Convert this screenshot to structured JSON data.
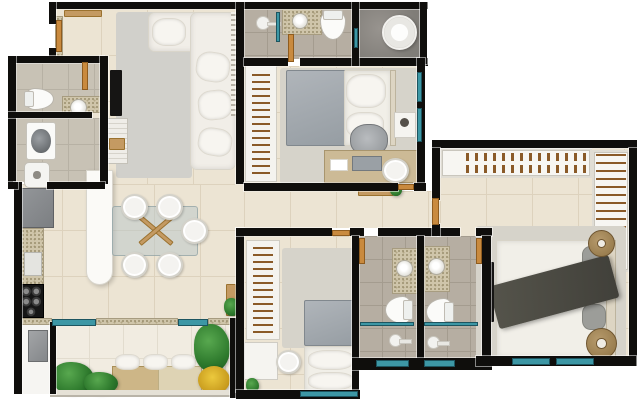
{
  "app": {
    "type": "3d-apartment-floor-plan-render",
    "background": "#ffffff",
    "canvas": {
      "width": 642,
      "height": 400
    }
  },
  "palette": {
    "wall": "#0f0e0c",
    "floor_beige": "#ece4d3",
    "floor_bath": "#b6aea2",
    "floor_dark_marble": "#8f8b86",
    "floor_balcony": "#f1ece1",
    "rug_gray": "#d1d0cb",
    "window_glass_teal": "#3d97a5",
    "door_wood": "#c98a3e",
    "granite_counter": "#cfc5aa",
    "sofa_white": "#f1eee8",
    "blanket_gray": "#a6acb1",
    "throw_dark": "#4d4c44",
    "plant_green": "#2e7a2d",
    "plant_yellow": "#dfb32a",
    "appliance_gray": "#8b8e91",
    "stove_black": "#161616",
    "closet_white": "#f7f6f2",
    "hanger_brown": "#8a5a28",
    "side_table_tan": "#a8906a"
  },
  "rooms": [
    {
      "n": "living-room-floor",
      "f": "beige",
      "x": 55,
      "y": 9,
      "w": 189,
      "h": 175
    },
    {
      "n": "kitchen-dining-floor",
      "f": "beige",
      "x": 16,
      "y": 184,
      "w": 228,
      "h": 136
    },
    {
      "n": "wc-floor",
      "f": "laundry",
      "x": 16,
      "y": 63,
      "w": 84,
      "h": 50
    },
    {
      "n": "laundry-floor",
      "f": "laundry",
      "x": 16,
      "y": 118,
      "w": 84,
      "h": 64
    },
    {
      "n": "top-bathroom-floor",
      "f": "bath",
      "x": 244,
      "y": 9,
      "w": 108,
      "h": 50
    },
    {
      "n": "shower-room-floor",
      "f": "dark",
      "x": 359,
      "y": 9,
      "w": 61,
      "h": 50
    },
    {
      "n": "bedroom2-floor",
      "f": "beige",
      "x": 244,
      "y": 66,
      "w": 173,
      "h": 117
    },
    {
      "n": "hallway-floor",
      "f": "beige",
      "x": 244,
      "y": 191,
      "w": 188,
      "h": 37
    },
    {
      "n": "master-entry-floor",
      "f": "beige",
      "x": 432,
      "y": 196,
      "w": 8,
      "h": 32
    },
    {
      "n": "master-suite-upper-floor",
      "f": "beige",
      "x": 440,
      "y": 148,
      "w": 189,
      "h": 88
    },
    {
      "n": "master-suite-lower-floor",
      "f": "beige",
      "x": 478,
      "y": 236,
      "w": 151,
      "h": 122
    },
    {
      "n": "bedroom3-floor",
      "f": "beige",
      "x": 244,
      "y": 236,
      "w": 108,
      "h": 156
    },
    {
      "n": "bathroom-a-floor",
      "f": "bath",
      "x": 359,
      "y": 236,
      "w": 58,
      "h": 124
    },
    {
      "n": "bathroom-b-floor",
      "f": "bath",
      "x": 424,
      "y": 236,
      "w": 58,
      "h": 124
    },
    {
      "n": "balcony-floor",
      "f": "balc",
      "x": 55,
      "y": 324,
      "w": 175,
      "h": 70
    },
    {
      "n": "service-closet-floor",
      "f": "white",
      "x": 22,
      "y": 322,
      "w": 28,
      "h": 72
    }
  ],
  "furniture": [
    {
      "n": "living-rug",
      "t": "rug",
      "x": 116,
      "y": 12,
      "w": 76,
      "h": 166
    },
    {
      "n": "sofa-top-section",
      "t": "sofa",
      "x": 148,
      "y": 12,
      "w": 88,
      "h": 40
    },
    {
      "n": "sofa-right-section",
      "t": "sofa",
      "x": 190,
      "y": 12,
      "w": 46,
      "h": 158
    },
    {
      "n": "sofa-chaise-cushion",
      "t": "pillow",
      "x": 152,
      "y": 18,
      "w": 34,
      "h": 28
    },
    {
      "n": "sofa-cushion",
      "t": "pillow",
      "x": 196,
      "y": 52,
      "w": 34,
      "h": 30,
      "r": 8
    },
    {
      "n": "sofa-cushion",
      "t": "pillow",
      "x": 198,
      "y": 90,
      "w": 34,
      "h": 30,
      "r": -6
    },
    {
      "n": "sofa-cushion",
      "t": "pillow",
      "x": 198,
      "y": 128,
      "w": 34,
      "h": 28,
      "r": 10
    },
    {
      "n": "slat-panel",
      "t": "slat",
      "x": 231,
      "y": 12,
      "w": 6,
      "h": 104
    },
    {
      "n": "living-tv",
      "t": "tv",
      "x": 110,
      "y": 70,
      "w": 12,
      "h": 46
    },
    {
      "n": "tv-cabinet",
      "t": "cabinet",
      "x": 106,
      "y": 118,
      "w": 22,
      "h": 46
    },
    {
      "n": "tv-cabinet-box",
      "t": "wood",
      "x": 109,
      "y": 138,
      "w": 16,
      "h": 12
    },
    {
      "n": "entry-shelf",
      "t": "wood",
      "x": 64,
      "y": 10,
      "w": 38,
      "h": 7
    },
    {
      "n": "entry-mat",
      "t": "granite",
      "x": 55,
      "y": 16,
      "w": 8,
      "h": 44
    },
    {
      "n": "wc-toilet",
      "t": "toilet",
      "x": 28,
      "y": 84,
      "w": 22,
      "h": 30,
      "r": -90
    },
    {
      "n": "wc-vanity",
      "t": "granite",
      "x": 62,
      "y": 96,
      "w": 40,
      "h": 17
    },
    {
      "n": "wc-sink",
      "t": "sink",
      "x": 70,
      "y": 99,
      "w": 17,
      "h": 17
    },
    {
      "n": "washing-machine",
      "t": "washer",
      "x": 26,
      "y": 122,
      "w": 30,
      "h": 38
    },
    {
      "n": "laundry-tank-sink",
      "t": "tanksink",
      "x": 24,
      "y": 162,
      "w": 26,
      "h": 26
    },
    {
      "n": "fridge",
      "t": "fridge",
      "x": 16,
      "y": 188,
      "w": 38,
      "h": 40
    },
    {
      "n": "kitchen-counter",
      "t": "granite",
      "x": 16,
      "y": 228,
      "w": 28,
      "h": 92
    },
    {
      "n": "kitchen-appliance",
      "t": "appliance-w",
      "x": 24,
      "y": 252,
      "w": 18,
      "h": 24
    },
    {
      "n": "stove-cooktop",
      "t": "stove",
      "x": 18,
      "y": 284,
      "w": 26,
      "h": 34
    },
    {
      "n": "kitchen-island",
      "t": "island",
      "x": 86,
      "y": 170,
      "w": 27,
      "h": 115
    },
    {
      "n": "dining-table-glass",
      "t": "glass",
      "x": 112,
      "y": 206,
      "w": 86,
      "h": 50
    },
    {
      "n": "table-base-beam",
      "t": "wood",
      "x": 135,
      "y": 228,
      "w": 42,
      "h": 5,
      "r": 40
    },
    {
      "n": "table-base-beam",
      "t": "wood",
      "x": 135,
      "y": 228,
      "w": 42,
      "h": 5,
      "r": -40
    },
    {
      "n": "dining-chair",
      "t": "chair",
      "x": 121,
      "y": 194,
      "w": 27,
      "h": 26
    },
    {
      "n": "dining-chair",
      "t": "chair",
      "x": 156,
      "y": 194,
      "w": 27,
      "h": 26
    },
    {
      "n": "dining-chair",
      "t": "chair",
      "x": 181,
      "y": 218,
      "w": 27,
      "h": 26
    },
    {
      "n": "dining-chair",
      "t": "chair",
      "x": 121,
      "y": 252,
      "w": 27,
      "h": 26
    },
    {
      "n": "dining-chair",
      "t": "chair",
      "x": 156,
      "y": 252,
      "w": 27,
      "h": 26
    },
    {
      "n": "wall-shelf",
      "t": "wood",
      "x": 226,
      "y": 284,
      "w": 10,
      "h": 32
    },
    {
      "n": "shelf-plant",
      "t": "plant",
      "x": 224,
      "y": 298,
      "w": 16,
      "h": 18
    },
    {
      "n": "window-sill",
      "t": "granite",
      "x": 14,
      "y": 318,
      "w": 38,
      "h": 7
    },
    {
      "n": "window-sill",
      "t": "granite",
      "x": 96,
      "y": 318,
      "w": 82,
      "h": 7
    },
    {
      "n": "window-sill",
      "t": "granite",
      "x": 208,
      "y": 318,
      "w": 28,
      "h": 7
    },
    {
      "n": "balcony-bench",
      "t": "bench",
      "x": 112,
      "y": 366,
      "w": 90,
      "h": 26
    },
    {
      "n": "balcony-bench-wicker",
      "t": "bench2",
      "x": 158,
      "y": 366,
      "w": 44,
      "h": 26
    },
    {
      "n": "bench-cushion",
      "t": "pillow",
      "x": 115,
      "y": 354,
      "w": 25,
      "h": 16
    },
    {
      "n": "bench-cushion",
      "t": "pillow",
      "x": 143,
      "y": 354,
      "w": 25,
      "h": 16
    },
    {
      "n": "bench-cushion",
      "t": "pillow",
      "x": 171,
      "y": 354,
      "w": 25,
      "h": 16
    },
    {
      "n": "balcony-plant",
      "t": "plant",
      "x": 52,
      "y": 362,
      "w": 42,
      "h": 32
    },
    {
      "n": "balcony-plant",
      "t": "plant",
      "x": 84,
      "y": 372,
      "w": 34,
      "h": 22
    },
    {
      "n": "balcony-tall-plant",
      "t": "plant",
      "x": 194,
      "y": 324,
      "w": 36,
      "h": 48
    },
    {
      "n": "balcony-yellow-plant",
      "t": "plant-y",
      "x": 198,
      "y": 366,
      "w": 32,
      "h": 28
    },
    {
      "n": "service-heater",
      "t": "appliance",
      "x": 28,
      "y": 330,
      "w": 20,
      "h": 32
    },
    {
      "n": "balcony-parapet",
      "t": "wall-light",
      "x": 50,
      "y": 390,
      "w": 188,
      "h": 7
    },
    {
      "n": "shower-head",
      "t": "shower",
      "x": 256,
      "y": 16,
      "w": 14,
      "h": 14
    },
    {
      "n": "bath-vanity",
      "t": "granite",
      "x": 282,
      "y": 9,
      "w": 40,
      "h": 26
    },
    {
      "n": "bath-sink",
      "t": "sink",
      "x": 292,
      "y": 13,
      "w": 16,
      "h": 16
    },
    {
      "n": "bath-toilet",
      "t": "toilet",
      "x": 320,
      "y": 10,
      "w": 26,
      "h": 30
    },
    {
      "n": "round-shower-tray",
      "t": "roundfix",
      "x": 382,
      "y": 15,
      "w": 35,
      "h": 35
    },
    {
      "n": "bedroom2-wardrobe",
      "t": "wardrobe",
      "x": 245,
      "y": 64,
      "w": 32,
      "h": 118
    },
    {
      "n": "bedroom2-rug",
      "t": "rug2",
      "x": 280,
      "y": 68,
      "w": 138,
      "h": 116
    },
    {
      "n": "bedroom2-bed-blanket",
      "t": "bedG",
      "x": 286,
      "y": 70,
      "w": 60,
      "h": 76
    },
    {
      "n": "bedroom2-bed-sheet",
      "t": "bedW",
      "x": 344,
      "y": 70,
      "w": 48,
      "h": 76
    },
    {
      "n": "bedroom2-pillow",
      "t": "pillow",
      "x": 346,
      "y": 74,
      "w": 40,
      "h": 34
    },
    {
      "n": "bedroom2-pillow",
      "t": "pillow",
      "x": 346,
      "y": 112,
      "w": 38,
      "h": 26
    },
    {
      "n": "bedroom2-headboard",
      "t": "headboard",
      "x": 390,
      "y": 70,
      "w": 6,
      "h": 76
    },
    {
      "n": "bedroom2-nightstand",
      "t": "cabinetW",
      "x": 394,
      "y": 112,
      "w": 22,
      "h": 26
    },
    {
      "n": "nightstand-lamp",
      "t": "dot",
      "x": 400,
      "y": 118,
      "w": 9,
      "h": 9
    },
    {
      "n": "office-chair",
      "t": "ochair",
      "x": 350,
      "y": 124,
      "w": 38,
      "h": 32
    },
    {
      "n": "bedroom2-desk",
      "t": "desk",
      "x": 324,
      "y": 150,
      "w": 96,
      "h": 33
    },
    {
      "n": "desk-laptop",
      "t": "laptop",
      "x": 352,
      "y": 156,
      "w": 30,
      "h": 15
    },
    {
      "n": "desk-paper",
      "t": "paper",
      "x": 330,
      "y": 159,
      "w": 18,
      "h": 12
    },
    {
      "n": "desk-chair",
      "t": "chair",
      "x": 382,
      "y": 158,
      "w": 27,
      "h": 25
    },
    {
      "n": "hall-console",
      "t": "wood",
      "x": 358,
      "y": 188,
      "w": 36,
      "h": 8
    },
    {
      "n": "hall-plant",
      "t": "plant",
      "x": 390,
      "y": 184,
      "w": 12,
      "h": 12
    },
    {
      "n": "master-closet-top",
      "t": "closet",
      "x": 440,
      "y": 148,
      "w": 152,
      "h": 30
    },
    {
      "n": "closet-shoe-row",
      "t": "shoes",
      "x": 466,
      "y": 153,
      "w": 122,
      "h": 8
    },
    {
      "n": "closet-shoe-row",
      "t": "shoes",
      "x": 466,
      "y": 165,
      "w": 122,
      "h": 8
    },
    {
      "n": "master-closet-right",
      "t": "closet",
      "x": 592,
      "y": 150,
      "w": 38,
      "h": 122
    },
    {
      "n": "closet-hanger-rail",
      "t": "hangv",
      "x": 596,
      "y": 154,
      "w": 30,
      "h": 114
    },
    {
      "n": "master-rug",
      "t": "rug2",
      "x": 476,
      "y": 226,
      "w": 150,
      "h": 136
    },
    {
      "n": "master-bed-duvet",
      "t": "bedW",
      "x": 496,
      "y": 240,
      "w": 102,
      "h": 118
    },
    {
      "n": "master-bed-pillow",
      "t": "pilG",
      "x": 582,
      "y": 246,
      "w": 24,
      "h": 24
    },
    {
      "n": "master-bed-pillow",
      "t": "pilG",
      "x": 582,
      "y": 274,
      "w": 24,
      "h": 26
    },
    {
      "n": "master-bed-pillow",
      "t": "pilG",
      "x": 582,
      "y": 304,
      "w": 24,
      "h": 26
    },
    {
      "n": "master-headboard",
      "t": "headboard",
      "x": 606,
      "y": 240,
      "w": 10,
      "h": 118
    },
    {
      "n": "master-throw-blanket",
      "t": "throw",
      "x": 492,
      "y": 270,
      "w": 124,
      "h": 44,
      "r": -15
    },
    {
      "n": "master-side-table",
      "t": "sidetable",
      "x": 588,
      "y": 230,
      "w": 27,
      "h": 27
    },
    {
      "n": "master-side-table",
      "t": "sidetable",
      "x": 586,
      "y": 328,
      "w": 31,
      "h": 31
    },
    {
      "n": "master-wall-tv",
      "t": "tv",
      "x": 488,
      "y": 262,
      "w": 6,
      "h": 60
    },
    {
      "n": "bedroom3-wardrobe",
      "t": "wardrobe",
      "x": 246,
      "y": 240,
      "w": 34,
      "h": 100
    },
    {
      "n": "bedroom3-rug",
      "t": "rug2",
      "x": 282,
      "y": 248,
      "w": 76,
      "h": 100
    },
    {
      "n": "bedroom3-bed-blanket",
      "t": "bedG",
      "x": 304,
      "y": 300,
      "w": 54,
      "h": 46
    },
    {
      "n": "bedroom3-bed-sheet",
      "t": "bedW",
      "x": 304,
      "y": 346,
      "w": 54,
      "h": 46
    },
    {
      "n": "bedroom3-pillow",
      "t": "pillow",
      "x": 308,
      "y": 350,
      "w": 46,
      "h": 20
    },
    {
      "n": "bedroom3-pillow",
      "t": "pillow",
      "x": 308,
      "y": 372,
      "w": 46,
      "h": 18
    },
    {
      "n": "bedroom3-desk",
      "t": "cabinetW",
      "x": 244,
      "y": 342,
      "w": 34,
      "h": 38
    },
    {
      "n": "bedroom3-chair",
      "t": "chair",
      "x": 276,
      "y": 350,
      "w": 25,
      "h": 24
    },
    {
      "n": "bedroom3-plant",
      "t": "plant",
      "x": 246,
      "y": 378,
      "w": 13,
      "h": 15
    },
    {
      "n": "bathroom-a-vanity",
      "t": "granite",
      "x": 392,
      "y": 248,
      "w": 26,
      "h": 46
    },
    {
      "n": "bathroom-a-sink",
      "t": "sink",
      "x": 396,
      "y": 260,
      "w": 17,
      "h": 17
    },
    {
      "n": "bathroom-a-toilet",
      "t": "toilet",
      "x": 385,
      "y": 296,
      "w": 28,
      "h": 28,
      "r": 90
    },
    {
      "n": "bathroom-a-shower-head",
      "t": "shower",
      "x": 389,
      "y": 334,
      "w": 13,
      "h": 13
    },
    {
      "n": "bathroom-b-vanity",
      "t": "granite",
      "x": 424,
      "y": 246,
      "w": 26,
      "h": 46
    },
    {
      "n": "bathroom-b-sink",
      "t": "sink",
      "x": 428,
      "y": 258,
      "w": 17,
      "h": 17
    },
    {
      "n": "bathroom-b-toilet",
      "t": "toilet",
      "x": 426,
      "y": 298,
      "w": 28,
      "h": 28,
      "r": 90
    },
    {
      "n": "bathroom-b-shower-head",
      "t": "shower",
      "x": 427,
      "y": 336,
      "w": 13,
      "h": 13
    }
  ],
  "walls": [
    [
      55,
      2,
      373,
      7
    ],
    [
      49,
      2,
      7,
      22
    ],
    [
      49,
      48,
      7,
      14
    ],
    [
      8,
      56,
      96,
      7
    ],
    [
      8,
      56,
      8,
      130
    ],
    [
      14,
      182,
      8,
      212
    ],
    [
      100,
      56,
      8,
      128
    ],
    [
      8,
      112,
      84,
      6
    ],
    [
      8,
      182,
      10,
      7
    ],
    [
      47,
      182,
      58,
      7
    ],
    [
      50,
      322,
      6,
      72
    ],
    [
      230,
      318,
      8,
      80
    ],
    [
      236,
      2,
      8,
      182
    ],
    [
      244,
      58,
      44,
      8
    ],
    [
      300,
      58,
      128,
      8
    ],
    [
      352,
      2,
      7,
      64
    ],
    [
      420,
      2,
      7,
      62
    ],
    [
      417,
      58,
      8,
      132
    ],
    [
      244,
      183,
      154,
      8
    ],
    [
      414,
      183,
      12,
      8
    ],
    [
      236,
      228,
      8,
      164
    ],
    [
      236,
      228,
      96,
      8
    ],
    [
      350,
      228,
      14,
      8
    ],
    [
      378,
      228,
      60,
      8
    ],
    [
      438,
      228,
      22,
      8
    ],
    [
      476,
      228,
      16,
      8
    ],
    [
      352,
      236,
      7,
      158
    ],
    [
      417,
      236,
      7,
      126
    ],
    [
      482,
      236,
      9,
      128
    ],
    [
      352,
      358,
      140,
      12
    ],
    [
      236,
      390,
      124,
      9
    ],
    [
      432,
      140,
      205,
      8
    ],
    [
      629,
      148,
      8,
      218
    ],
    [
      476,
      356,
      160,
      10
    ],
    [
      432,
      148,
      8,
      52
    ],
    [
      432,
      224,
      8,
      12
    ]
  ],
  "windows": [
    [
      52,
      319,
      44,
      7
    ],
    [
      178,
      319,
      30,
      7
    ],
    [
      276,
      12,
      4,
      30
    ],
    [
      354,
      28,
      4,
      20
    ],
    [
      417,
      72,
      5,
      30
    ],
    [
      417,
      108,
      5,
      34
    ],
    [
      512,
      358,
      38,
      7
    ],
    [
      556,
      358,
      38,
      7
    ],
    [
      300,
      391,
      58,
      6
    ],
    [
      376,
      360,
      33,
      7
    ],
    [
      424,
      360,
      31,
      7
    ],
    [
      360,
      322,
      54,
      4
    ],
    [
      424,
      322,
      54,
      4
    ]
  ],
  "doors": [
    [
      56,
      20,
      6,
      32
    ],
    [
      82,
      62,
      6,
      28
    ],
    [
      288,
      34,
      6,
      28
    ],
    [
      398,
      184,
      16,
      6
    ],
    [
      432,
      198,
      7,
      27
    ],
    [
      332,
      230,
      18,
      6
    ],
    [
      359,
      238,
      6,
      26
    ],
    [
      476,
      238,
      6,
      26
    ]
  ]
}
